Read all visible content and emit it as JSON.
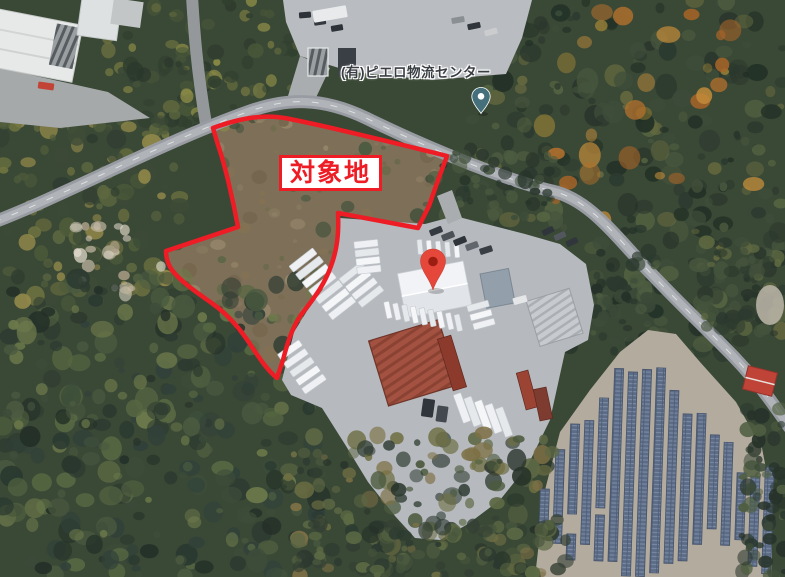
{
  "meta": {
    "view": "satellite-aerial-map",
    "width": 785,
    "height": 577
  },
  "labels": {
    "site_area": "対象地",
    "place": "(有)ピエロ物流センター"
  },
  "colors": {
    "overlay_red": "#ee1c25",
    "label_bg": "#ffffff",
    "place_label": "#3a3f43",
    "pin_red": "#e5473b",
    "pin_red_core": "#9c1d12",
    "pin_teal": "#45707b",
    "pin_core_white": "#ffffff"
  },
  "scene": {
    "regions": [
      {
        "name": "top-strip",
        "x": 105,
        "y": 0,
        "w": 195,
        "h": 128,
        "count": 120,
        "rmin": 3,
        "rmax": 9,
        "seed": 11,
        "colors": [
          "#31402f",
          "#4a5839",
          "#6a6f3f",
          "#8a8a46",
          "#3a4936",
          "#2a372c"
        ]
      },
      {
        "name": "left-strip",
        "x": 0,
        "y": 112,
        "w": 180,
        "h": 200,
        "count": 130,
        "rmin": 3,
        "rmax": 10,
        "seed": 22,
        "colors": [
          "#4e5c3a",
          "#6f7340",
          "#93894a",
          "#3c4a37",
          "#5d6840",
          "#2f3d31"
        ]
      },
      {
        "name": "right-forest",
        "x": 470,
        "y": 0,
        "w": 315,
        "h": 355,
        "count": 300,
        "rmin": 3,
        "rmax": 11,
        "seed": 33,
        "colors": [
          "#2c3a2f",
          "#3e4e3a",
          "#546341",
          "#2a362c",
          "#47563d",
          "#65693f",
          "#223026"
        ]
      },
      {
        "name": "orange-patches",
        "x": 520,
        "y": 0,
        "w": 240,
        "h": 220,
        "count": 30,
        "rmin": 4,
        "rmax": 12,
        "seed": 44,
        "colors": [
          "#b06f2d",
          "#c08a3a",
          "#a86428",
          "#8f7a35"
        ]
      },
      {
        "name": "scrub",
        "x": 160,
        "y": 105,
        "w": 290,
        "h": 280,
        "count": 230,
        "rmin": 2,
        "rmax": 8,
        "seed": 55,
        "clip": "site",
        "colors": [
          "#8a7b62",
          "#75664e",
          "#9a8a6e",
          "#5c6647",
          "#4a5a40",
          "#6b6b4a",
          "#3f4f3b",
          "#857252"
        ]
      },
      {
        "name": "clearing",
        "x": 72,
        "y": 226,
        "w": 92,
        "h": 68,
        "count": 24,
        "rmin": 3,
        "rmax": 8,
        "seed": 66,
        "colors": [
          "#cfc8b8",
          "#bfb5a0",
          "#a79b83",
          "#ddd6c8"
        ]
      },
      {
        "name": "roadside-trees",
        "x": 425,
        "y": 152,
        "w": 135,
        "h": 66,
        "count": 55,
        "rmin": 3,
        "rmax": 8,
        "seed": 77,
        "colors": [
          "#2c3a2f",
          "#3e4e3a",
          "#4c5c40",
          "#27342a"
        ]
      },
      {
        "name": "road-left-band",
        "x": 596,
        "y": 252,
        "w": 62,
        "h": 100,
        "count": 55,
        "rmin": 3,
        "rmax": 8,
        "seed": 88,
        "colors": [
          "#2c3a2f",
          "#3b4a38",
          "#4e5d41",
          "#253128"
        ]
      },
      {
        "name": "road-right-band",
        "x": 700,
        "y": 238,
        "w": 85,
        "h": 100,
        "count": 60,
        "rmin": 3,
        "rmax": 9,
        "seed": 99,
        "colors": [
          "#2c3a2f",
          "#44533c",
          "#5d6841",
          "#29352b"
        ]
      },
      {
        "name": "bottom-left-forest",
        "x": 0,
        "y": 278,
        "w": 325,
        "h": 299,
        "count": 330,
        "rmin": 3,
        "rmax": 12,
        "seed": 101,
        "colors": [
          "#2b3930",
          "#3d4d3a",
          "#566742",
          "#6d7a4b",
          "#31413a",
          "#243028",
          "#4a5a40"
        ]
      },
      {
        "name": "bottom-center-forest",
        "x": 288,
        "y": 428,
        "w": 265,
        "h": 149,
        "count": 160,
        "rmin": 3,
        "rmax": 10,
        "seed": 112,
        "colors": [
          "#2f3d31",
          "#4c5a3e",
          "#6e6f43",
          "#7d7045",
          "#5d6844",
          "#27332a"
        ]
      },
      {
        "name": "bottom-edge-trees",
        "x": 295,
        "y": 515,
        "w": 275,
        "h": 62,
        "count": 70,
        "rmin": 3,
        "rmax": 9,
        "seed": 123,
        "colors": [
          "#2b3930",
          "#46543c",
          "#5c6a44",
          "#333f33"
        ]
      },
      {
        "name": "solar-edge-trees",
        "x": 742,
        "y": 408,
        "w": 43,
        "h": 169,
        "count": 60,
        "rmin": 3,
        "rmax": 9,
        "seed": 134,
        "colors": [
          "#2b3930",
          "#3c4b39",
          "#4f5e41",
          "#27332a"
        ]
      }
    ],
    "trailer_groups": [
      {
        "x": 303,
        "y": 260,
        "angle": -38,
        "count": 7,
        "dx": 6.5,
        "dy": 8,
        "len": 30,
        "wid": 7.5
      },
      {
        "x": 352,
        "y": 273,
        "angle": -38,
        "count": 4,
        "dx": 6.3,
        "dy": 7.8,
        "len": 28,
        "wid": 7
      },
      {
        "x": 290,
        "y": 350,
        "angle": -35,
        "count": 5,
        "dx": 6,
        "dy": 8.5,
        "len": 26,
        "wid": 7
      },
      {
        "x": 366,
        "y": 244,
        "angle": -6,
        "count": 4,
        "dx": 1,
        "dy": 8.5,
        "len": 24,
        "wid": 7
      },
      {
        "x": 420,
        "y": 247,
        "angle": 85,
        "count": 5,
        "dx": 9.2,
        "dy": 0.8,
        "len": 15,
        "wid": 5
      },
      {
        "x": 388,
        "y": 310,
        "angle": 78,
        "count": 9,
        "dx": 8.8,
        "dy": 1.6,
        "len": 17,
        "wid": 5.5
      },
      {
        "x": 462,
        "y": 408,
        "angle": 70,
        "count": 5,
        "dx": 10.5,
        "dy": 3.5,
        "len": 30,
        "wid": 8
      },
      {
        "x": 478,
        "y": 306,
        "angle": -15,
        "count": 3,
        "dx": 3,
        "dy": 9,
        "len": 22,
        "wid": 6.5
      }
    ],
    "trailer_fills": [
      "#eef0f3",
      "#e6e9ec",
      "#f4f6f8"
    ],
    "cars": [
      {
        "x": 436,
        "y": 231,
        "w": 13,
        "h": 6.5,
        "angle": -22,
        "color": "#343a40"
      },
      {
        "x": 448,
        "y": 236,
        "w": 13,
        "h": 6.5,
        "angle": -22,
        "color": "#4b5157"
      },
      {
        "x": 460,
        "y": 241,
        "w": 13,
        "h": 6.5,
        "angle": -22,
        "color": "#2e343a"
      },
      {
        "x": 472,
        "y": 246,
        "w": 13,
        "h": 6.5,
        "angle": -20,
        "color": "#60666c"
      },
      {
        "x": 486,
        "y": 250,
        "w": 13,
        "h": 6.5,
        "angle": -18,
        "color": "#383e44"
      },
      {
        "x": 548,
        "y": 231,
        "w": 12,
        "h": 6,
        "angle": -25,
        "color": "#2f353b"
      },
      {
        "x": 560,
        "y": 236,
        "w": 12,
        "h": 6,
        "angle": -25,
        "color": "#51575d"
      },
      {
        "x": 572,
        "y": 242,
        "w": 12,
        "h": 6,
        "angle": -25,
        "color": "#30363c"
      },
      {
        "x": 305,
        "y": 15,
        "w": 12,
        "h": 6,
        "angle": -5,
        "color": "#2c3238"
      },
      {
        "x": 320,
        "y": 22,
        "w": 12,
        "h": 6,
        "angle": -8,
        "color": "#33393f"
      },
      {
        "x": 337,
        "y": 28,
        "w": 12,
        "h": 6,
        "angle": -10,
        "color": "#2c3238"
      },
      {
        "x": 458,
        "y": 20,
        "w": 13,
        "h": 6,
        "angle": -10,
        "color": "#8a8f94"
      },
      {
        "x": 474,
        "y": 26,
        "w": 13,
        "h": 6,
        "angle": -12,
        "color": "#2f353b"
      },
      {
        "x": 491,
        "y": 32,
        "w": 13,
        "h": 6,
        "angle": -14,
        "color": "#caccce"
      },
      {
        "x": 330,
        "y": 14,
        "w": 34,
        "h": 12,
        "angle": -10,
        "color": "#e8eaec"
      },
      {
        "x": 428,
        "y": 408,
        "w": 12,
        "h": 18,
        "angle": 8,
        "color": "#2f353b"
      },
      {
        "x": 442,
        "y": 414,
        "w": 11,
        "h": 16,
        "angle": 8,
        "color": "#43494f"
      },
      {
        "x": 46,
        "y": 86,
        "w": 16,
        "h": 7,
        "angle": 8,
        "color": "#c14436"
      },
      {
        "x": 520,
        "y": 300,
        "w": 14,
        "h": 7,
        "angle": -15,
        "color": "#e4e6e8"
      }
    ],
    "containers": [
      {
        "x": 452,
        "y": 363,
        "w": 14,
        "h": 54,
        "angle": -17,
        "color": "#8c3a2c"
      },
      {
        "x": 527,
        "y": 390,
        "w": 12,
        "h": 38,
        "angle": -15,
        "color": "#9c4434"
      },
      {
        "x": 543,
        "y": 404,
        "w": 13,
        "h": 32,
        "angle": -12,
        "color": "#7e3b2f"
      }
    ],
    "solar": {
      "panel_width": 9,
      "tilt": 2,
      "stroke": "#46536b",
      "columns": [
        {
          "x": 546,
          "segs": [
            [
              493,
              533
            ]
          ]
        },
        {
          "x": 560,
          "segs": [
            [
              453,
              520
            ],
            [
              527,
              547
            ]
          ]
        },
        {
          "x": 574,
          "segs": [
            [
              427,
              517
            ],
            [
              537,
              563
            ]
          ]
        },
        {
          "x": 588,
          "segs": [
            [
              423,
              547
            ]
          ]
        },
        {
          "x": 602,
          "segs": [
            [
              400,
              510
            ],
            [
              517,
              563
            ]
          ]
        },
        {
          "x": 616,
          "segs": [
            [
              370,
              563
            ]
          ]
        },
        {
          "x": 630,
          "segs": [
            [
              373,
              577
            ]
          ]
        },
        {
          "x": 644,
          "segs": [
            [
              370,
              577
            ]
          ]
        },
        {
          "x": 658,
          "segs": [
            [
              368,
              573
            ]
          ]
        },
        {
          "x": 672,
          "segs": [
            [
              390,
              563
            ]
          ]
        },
        {
          "x": 686,
          "segs": [
            [
              413,
              560
            ]
          ]
        },
        {
          "x": 700,
          "segs": [
            [
              412,
              543
            ]
          ]
        },
        {
          "x": 714,
          "segs": [
            [
              433,
              527
            ]
          ]
        },
        {
          "x": 728,
          "segs": [
            [
              440,
              543
            ]
          ]
        },
        {
          "x": 742,
          "segs": [
            [
              470,
              537
            ]
          ]
        },
        {
          "x": 756,
          "segs": [
            [
              473,
              563
            ]
          ]
        },
        {
          "x": 770,
          "segs": [
            [
              463,
              570
            ]
          ]
        }
      ]
    }
  }
}
